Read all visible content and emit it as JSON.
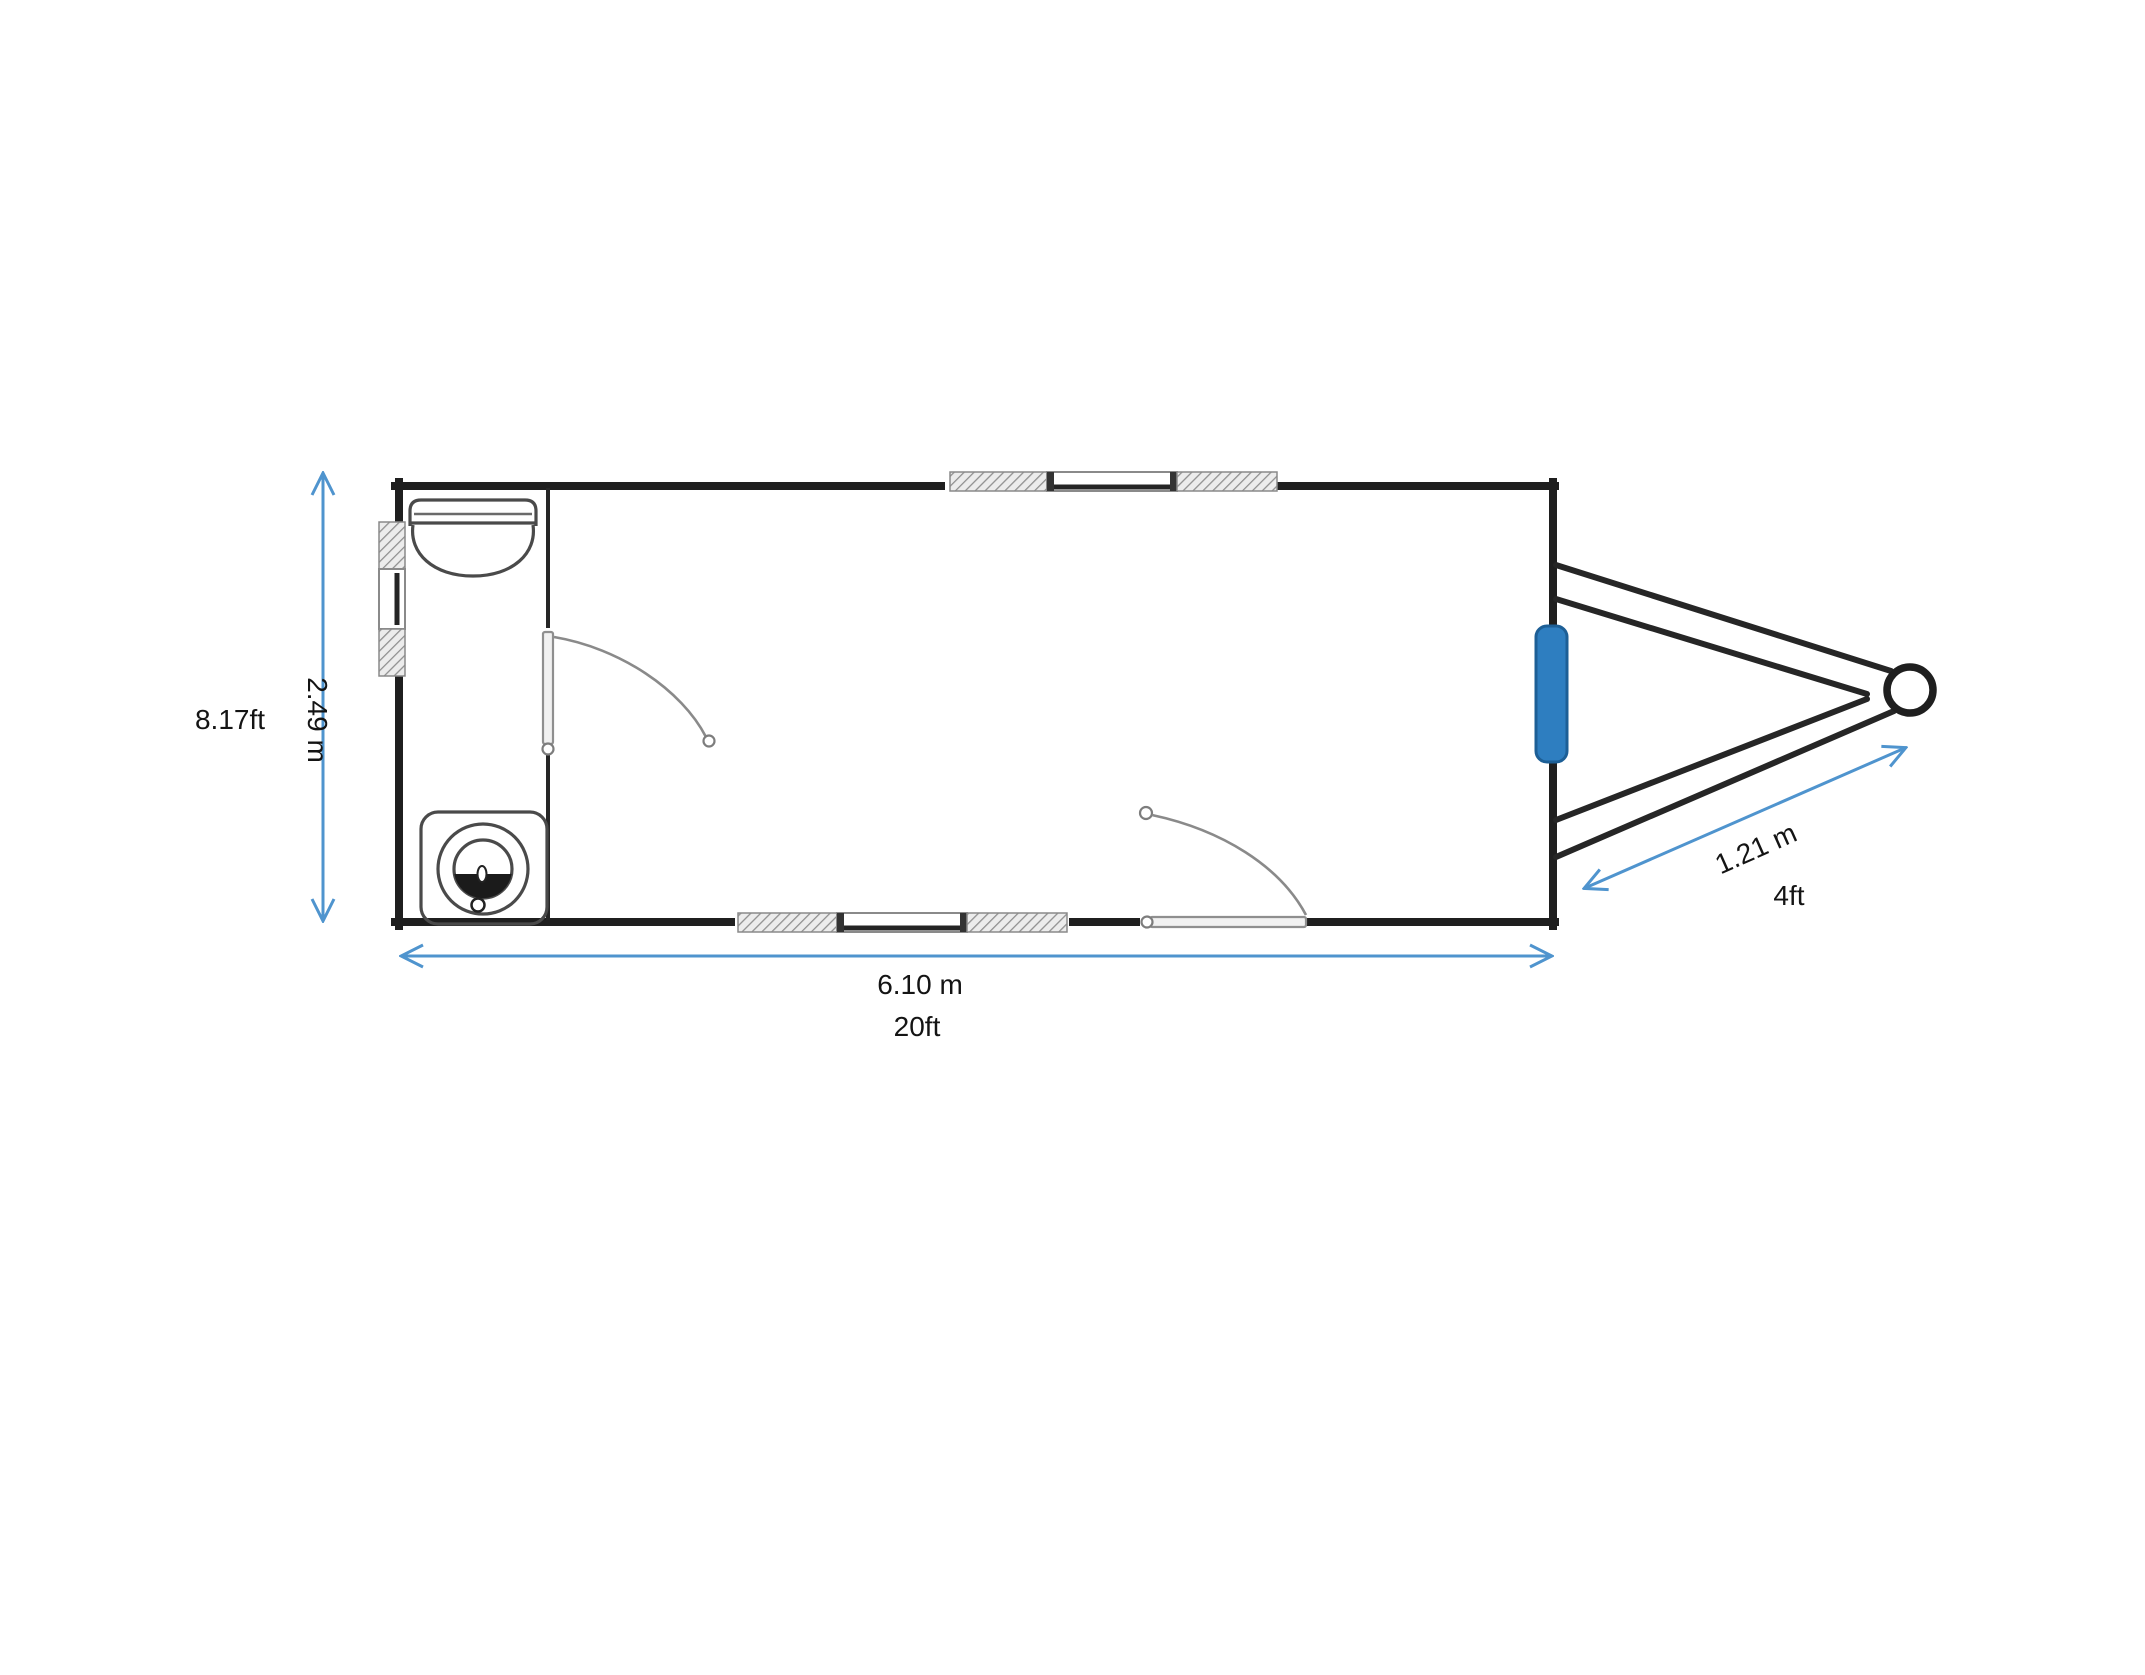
{
  "diagram": {
    "title": "trailer floor plan",
    "type": "floor-plan",
    "dimensions": {
      "width": {
        "imperial": "8.17ft",
        "metric": "2.49 m"
      },
      "length": {
        "metric": "6.10 m",
        "imperial": "20ft"
      },
      "tongue": {
        "metric": "1.21 m",
        "imperial": "4ft"
      }
    },
    "colors": {
      "dimension_blue": "#4f94ce",
      "tongue_pad": "#2e7ec0",
      "wall_black": "#1f1f1f"
    },
    "elements": {
      "body": "trailer-body-outline",
      "room": "washroom-partition",
      "fixtures": [
        "sink",
        "toilet"
      ],
      "windows": [
        "window-top-wall",
        "window-bottom-wall",
        "window-left-wall"
      ],
      "doors": [
        "interior-door",
        "entry-door"
      ],
      "tongue": [
        "a-frame-drawbar",
        "hitch-coupler",
        "tongue-pad"
      ]
    }
  }
}
